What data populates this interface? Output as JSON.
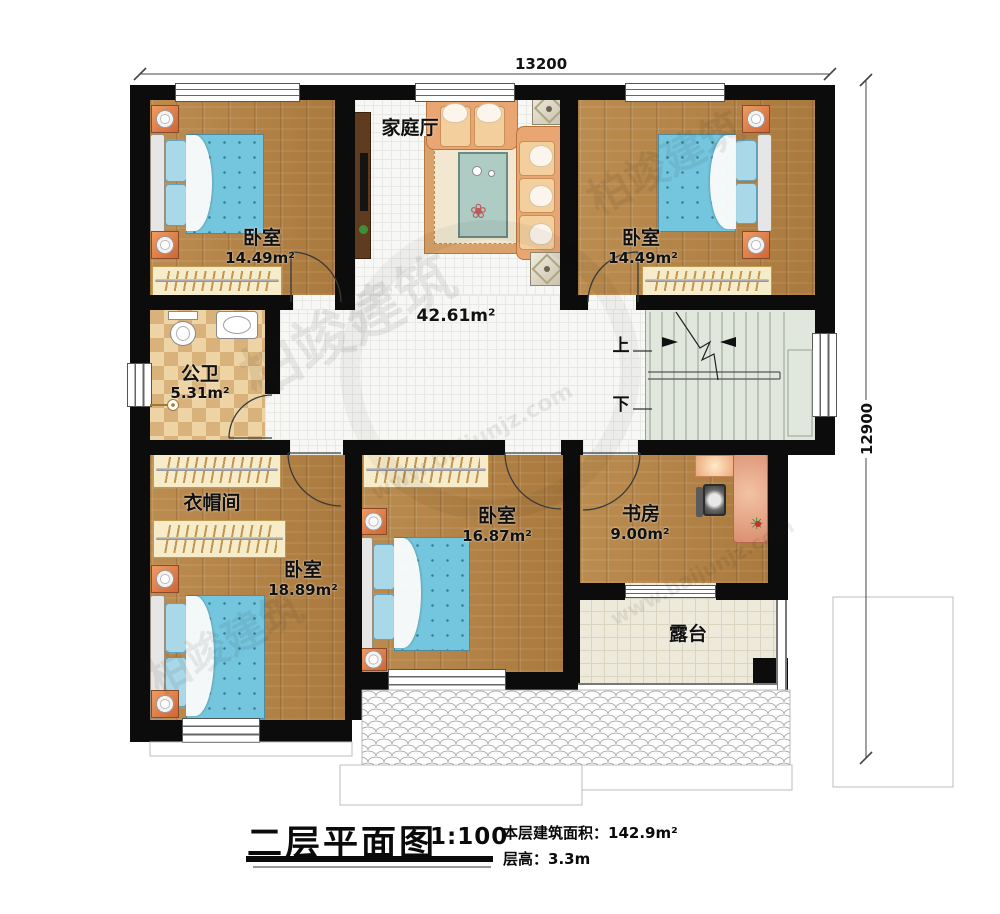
{
  "dimensions": {
    "top": "13200",
    "right": "12900"
  },
  "rooms": {
    "family_hall": {
      "label": "家庭厅"
    },
    "hall": {
      "area": "42.61m²"
    },
    "bedroom_top_left": {
      "label": "卧室",
      "area": "14.49m²"
    },
    "bedroom_top_right": {
      "label": "卧室",
      "area": "14.49m²"
    },
    "bathroom": {
      "label": "公卫",
      "area": "5.31m²"
    },
    "cloakroom": {
      "label": "衣帽间"
    },
    "bedroom_bottom_left": {
      "label": "卧室",
      "area": "18.89m²"
    },
    "bedroom_bottom_middle": {
      "label": "卧室",
      "area": "16.87m²"
    },
    "study": {
      "label": "书房",
      "area": "9.00m²"
    },
    "terrace": {
      "label": "露台"
    }
  },
  "stairs": {
    "up": "上",
    "down": "下"
  },
  "title_block": {
    "title": "二层平面图",
    "scale": "1:100",
    "area_label": "本层建筑面积：",
    "area_value": "142.9m²",
    "floor_height_label": "层高：",
    "floor_height_value": "3.3m"
  },
  "watermark": {
    "name": "柏竣建筑",
    "url": "www.baijunjz.com"
  },
  "colors": {
    "wall": "#0c0c0c",
    "wood": "#b1803f",
    "stairs": "#e1e7dd",
    "terrace": "#edeadb",
    "bed": "#74c6de"
  }
}
